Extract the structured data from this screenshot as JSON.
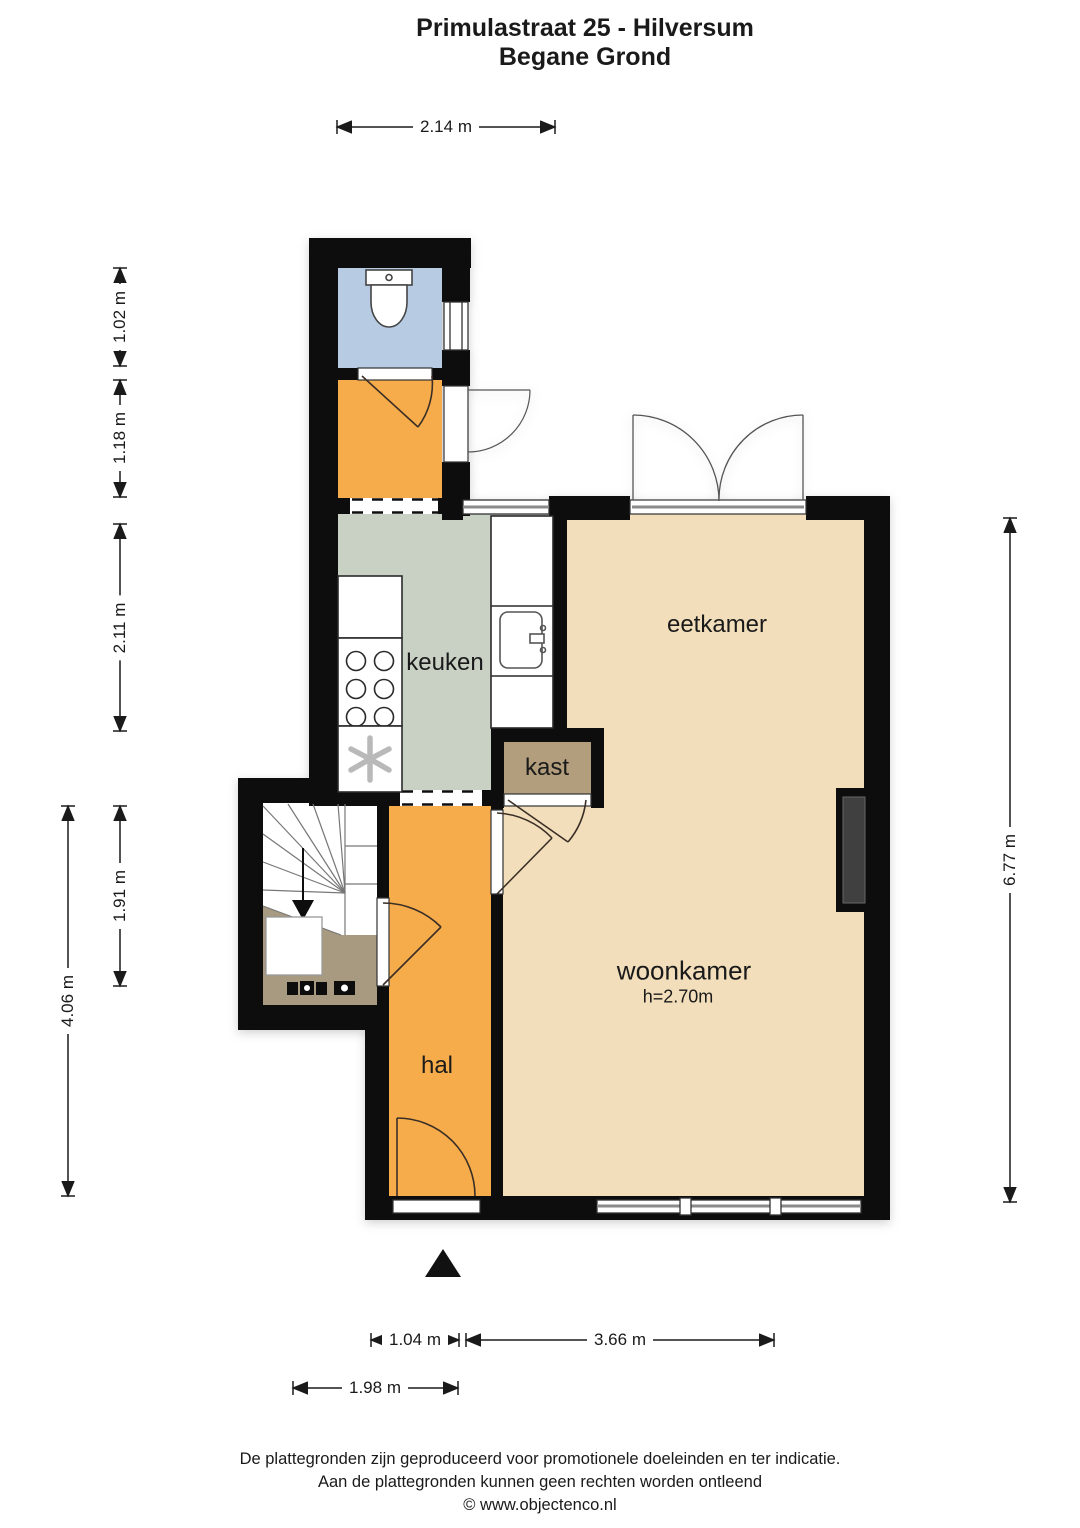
{
  "title": {
    "line1": "Primulastraat 25 - Hilversum",
    "line2": "Begane Grond"
  },
  "rooms": {
    "eetkamer": "eetkamer",
    "keuken": "keuken",
    "kast": "kast",
    "woonkamer": "woonkamer",
    "woonkamer_ceiling": "h=2.70m",
    "hal": "hal"
  },
  "dimensions": {
    "top": "2.14 m",
    "left": [
      "1.02 m",
      "1.18 m",
      "2.11 m",
      "1.91 m",
      "4.06 m"
    ],
    "right": "6.77 m",
    "bottom": [
      "1.04 m",
      "3.66 m",
      "1.98 m"
    ]
  },
  "footer": {
    "line1": "De plattegronden zijn geproduceerd voor promotionele doeleinden en ter indicatie.",
    "line2": "Aan de plattegronden kunnen geen rechten worden ontleend",
    "line3": "© www.objectenco.nl"
  },
  "colors": {
    "wall": "#0b0b0b",
    "floor_living": "#f2debb",
    "floor_hall": "#f6ac4b",
    "floor_kitchen": "#c9d1c5",
    "floor_toilet": "#b7cbe3",
    "floor_closet": "#b29d7c",
    "floor_meter_cupboard": "#a89a80",
    "chimney": "#3f3f41",
    "dimension_line": "#1a1a1a"
  }
}
